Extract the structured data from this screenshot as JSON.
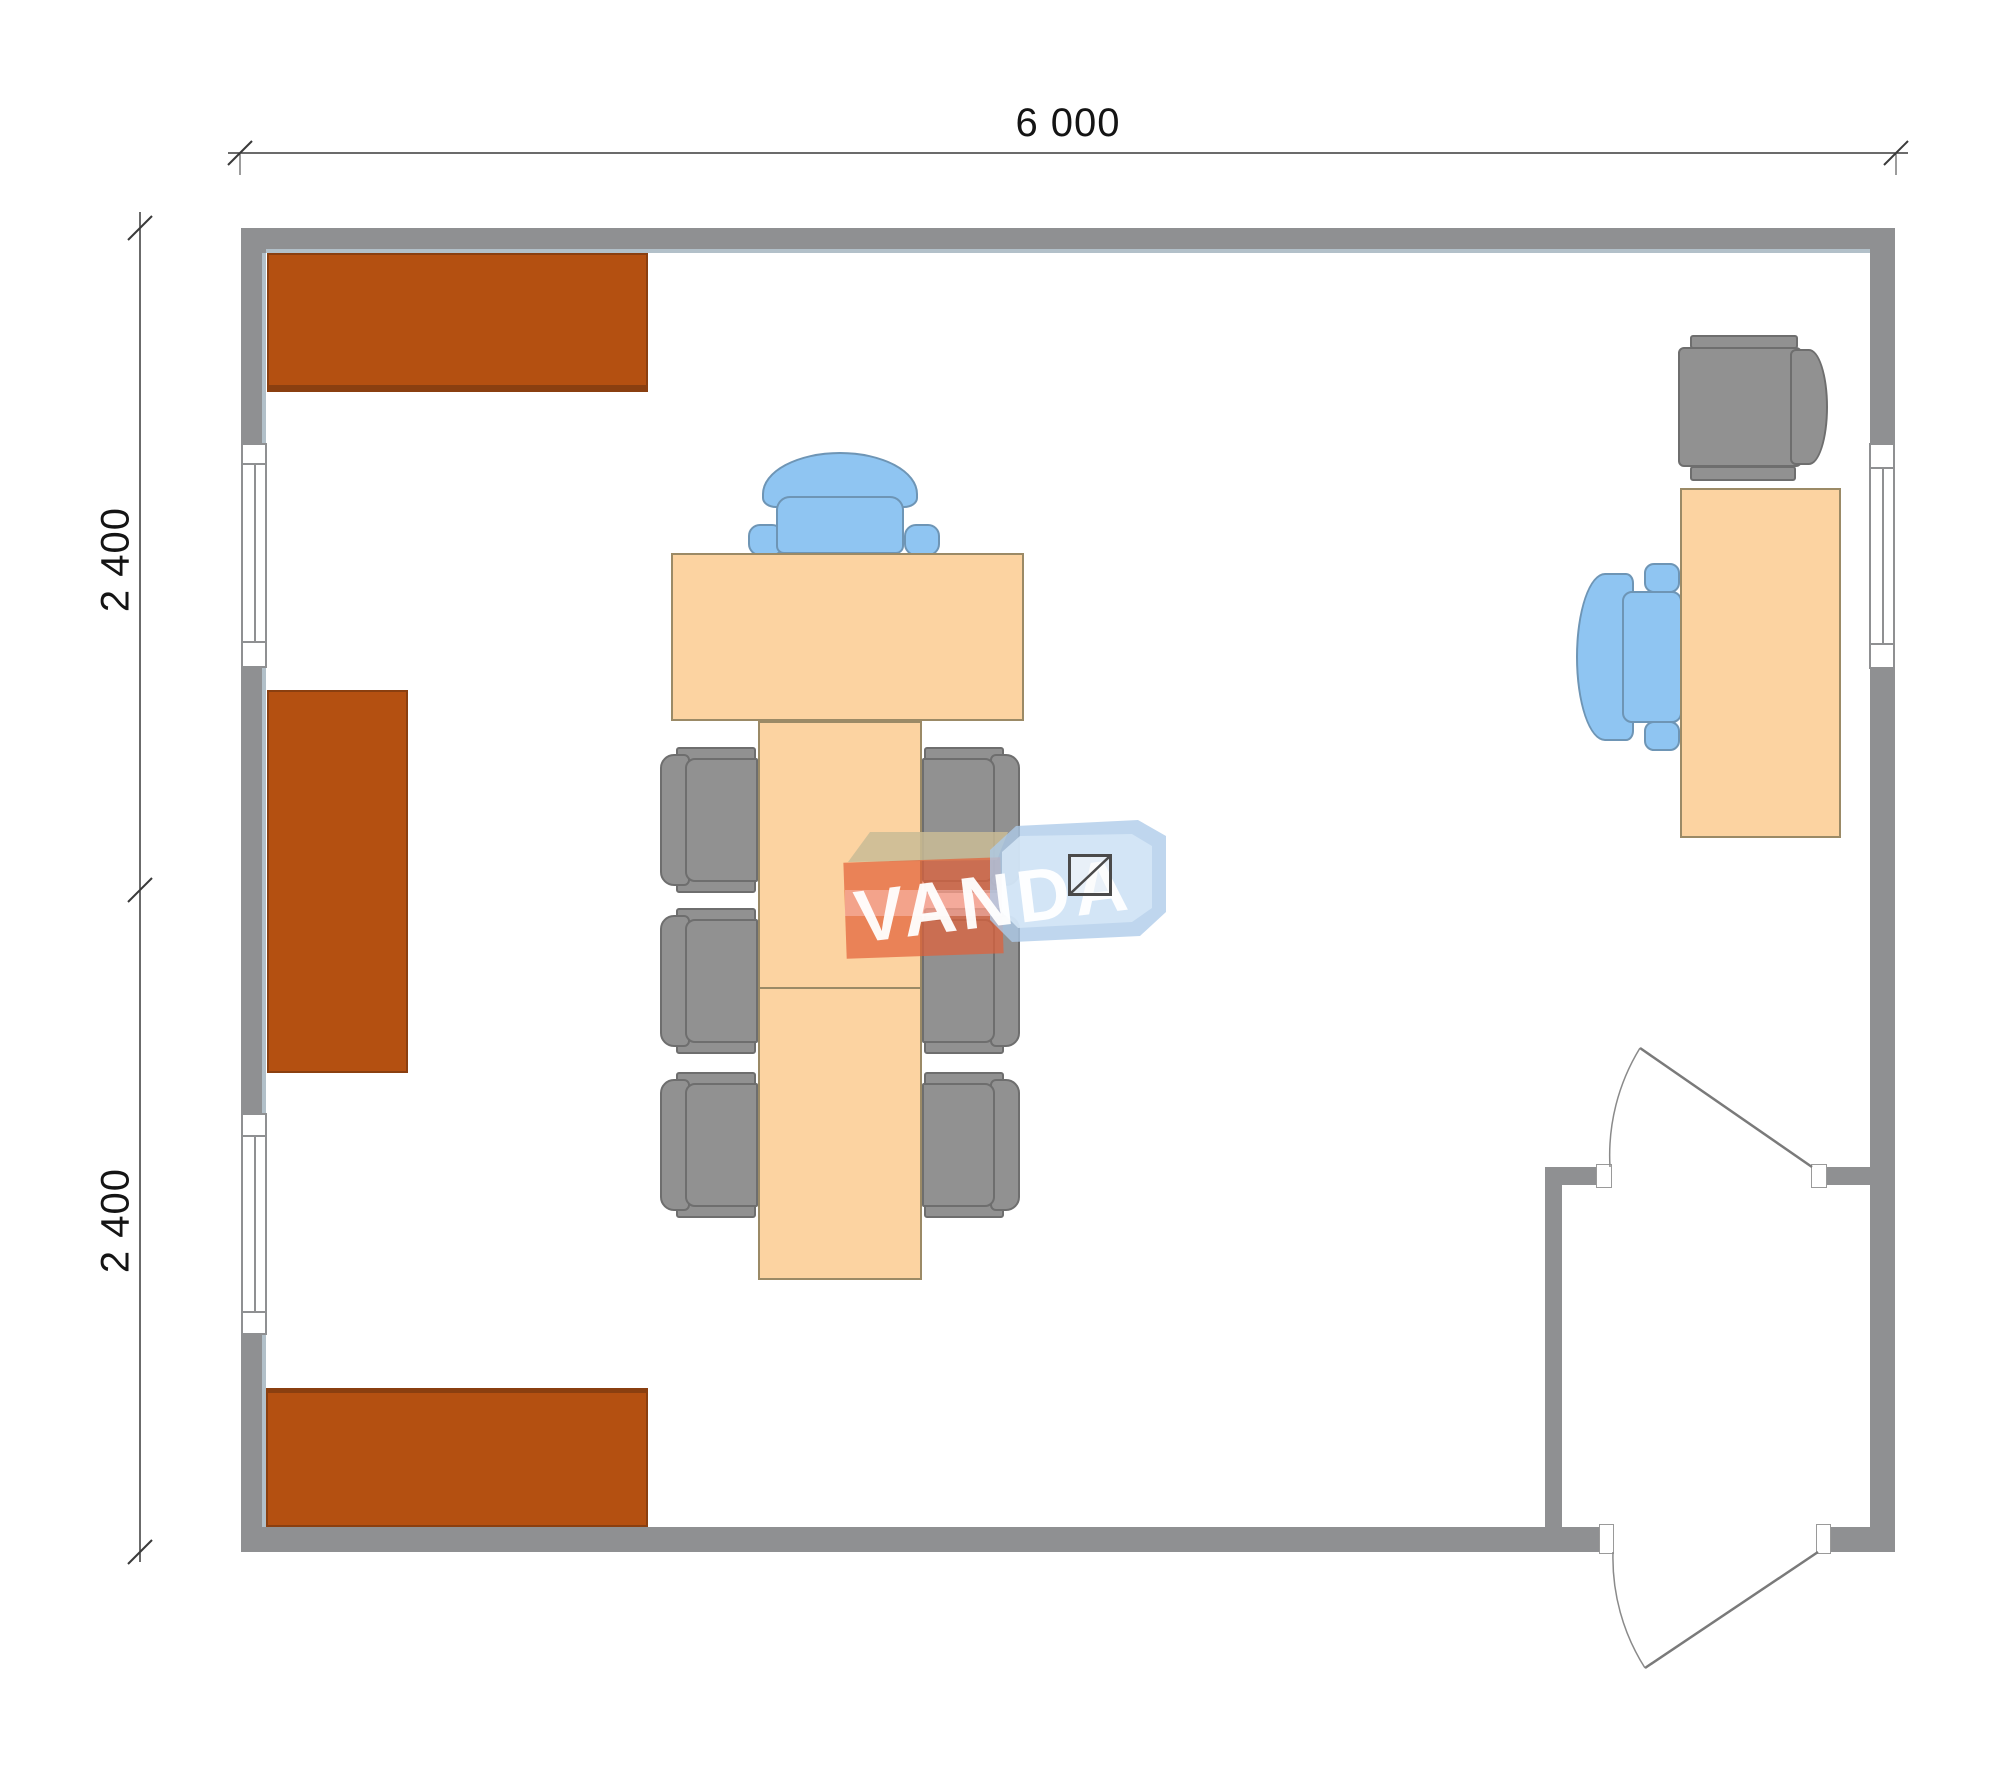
{
  "plan": {
    "type": "office-floor-plan",
    "dimensions": {
      "width_label": "6 000",
      "height_upper_label": "2 400",
      "height_lower_label": "2 400"
    },
    "watermark": {
      "brand": "VANDA"
    },
    "colors": {
      "wall": "#8f9092",
      "cabinet": "#b45011",
      "table": "#fcd3a1",
      "chair_gray": "#919191",
      "chair_blue": "#8fc5f2",
      "watermark_orange": "#e26038",
      "watermark_blue": "#adcbe9",
      "background": "#ffffff"
    },
    "furniture": [
      "wall-cabinet-top",
      "wall-cabinet-left",
      "wall-cabinet-bottom",
      "conference-head-table",
      "conference-table-column",
      "conference-chair-gray-left-1",
      "conference-chair-gray-left-2",
      "conference-chair-gray-left-3",
      "conference-chair-gray-right-1",
      "conference-chair-gray-right-2",
      "conference-chair-gray-right-3",
      "conference-chair-blue-head",
      "desk",
      "desk-chair-gray",
      "desk-chair-blue"
    ],
    "openings": [
      "window-left-upper",
      "window-left-lower",
      "window-right",
      "interior-door",
      "exterior-door"
    ]
  }
}
